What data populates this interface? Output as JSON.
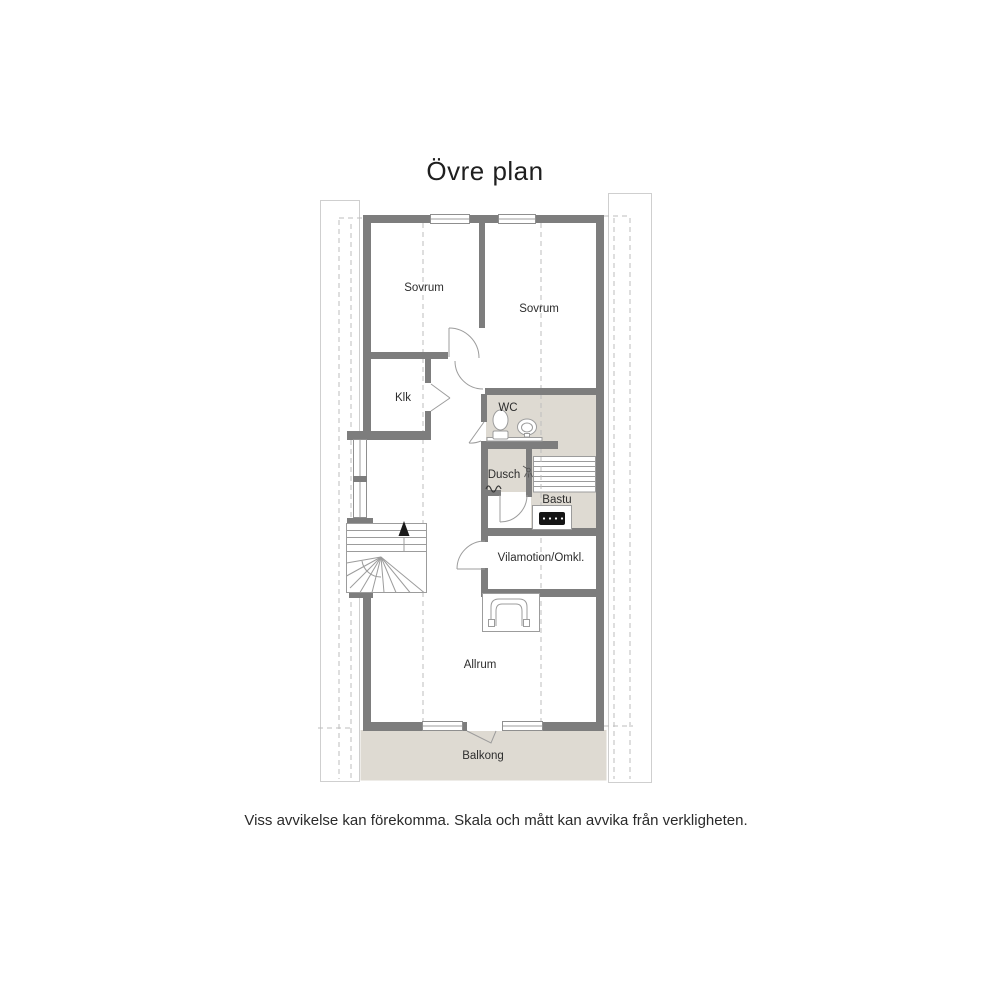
{
  "title": "Övre plan",
  "disclaimer": "Viss avvikelse kan förekomma. Skala och mått kan avvika från verkligheten.",
  "rooms": {
    "sovrum1": "Sovrum",
    "sovrum2": "Sovrum",
    "klk": "Klk",
    "wc": "WC",
    "dusch": "Dusch",
    "bastu": "Bastu",
    "vilamotion": "Vilamotion/Omkl.",
    "allrum": "Allrum",
    "balkong": "Balkong"
  },
  "icons": {
    "stair_direction": "up-arrow",
    "shower": "shower-head",
    "water": "wavy-line",
    "sauna_heater": "heater-box",
    "fireplace": "arch-stove"
  },
  "colors": {
    "wall": "#7d7d7d",
    "floor_accent": "#dedad2",
    "line": "#9c9c9c",
    "dashed": "#bdbdbd",
    "roof_outline": "#cfcfcf",
    "text": "#2d2d2d"
  }
}
